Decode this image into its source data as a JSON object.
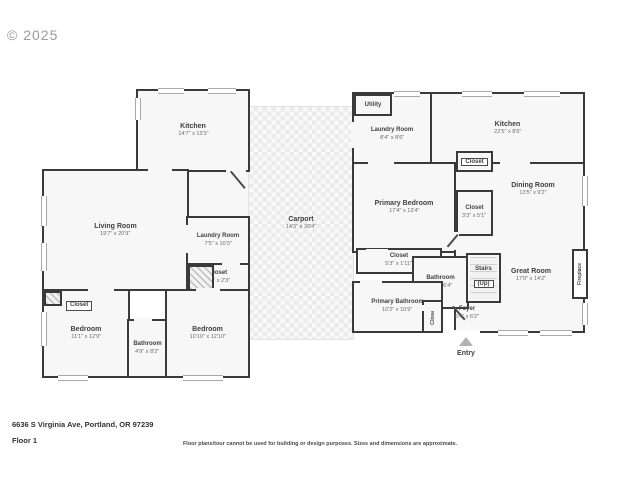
{
  "watermark": "© 2025",
  "colors": {
    "wall": "#3a3a3a",
    "room_fill": "#f7f7f7",
    "carport_check": "#ebebeb"
  },
  "rooms": {
    "kitchen_left": {
      "name": "Kitchen",
      "dims": "14'7\" x 13'3\""
    },
    "living_room": {
      "name": "Living Room",
      "dims": "19'7\" x 20'9\""
    },
    "laundry_left": {
      "name": "Laundry Room",
      "dims": "7'5\" x 10'3\""
    },
    "closet_hall": {
      "name": "Closet",
      "dims": "5'7\" x 2'3\""
    },
    "bedroom_closet": {
      "name": "Closet"
    },
    "bedroom_1": {
      "name": "Bedroom",
      "dims": "11'1\" x 12'9\""
    },
    "bathroom_left": {
      "name": "Bathroom",
      "dims": "4'9\" x 8'2\""
    },
    "bedroom_2": {
      "name": "Bedroom",
      "dims": "10'10\" x 12'10\""
    },
    "carport": {
      "name": "Carport",
      "dims": "14'3\" x 30'4\""
    },
    "utility": {
      "name": "Utility"
    },
    "laundry_right": {
      "name": "Laundry Room",
      "dims": "8'4\" x 8'6\""
    },
    "kitchen_right": {
      "name": "Kitchen",
      "dims": "22'5\" x 8'6\""
    },
    "closet_top": {
      "name": "Closet"
    },
    "primary_bedroom": {
      "name": "Primary Bedroom",
      "dims": "17'4\" x 13'4\""
    },
    "dining_room": {
      "name": "Dining Room",
      "dims": "13'5\" x 9'2\""
    },
    "closet_primary": {
      "name": "Closet",
      "dims": "3'3\" x 5'1\""
    },
    "closet_hall_right": {
      "name": "Closet",
      "dims": "5'3\" x 1'11\""
    },
    "bathroom_right": {
      "name": "Bathroom",
      "dims": "5'9\" x 6'4\""
    },
    "stairs": {
      "name": "Stairs",
      "sub": "(Up)"
    },
    "great_room": {
      "name": "Great Room",
      "dims": "17'0\" x 14'2\""
    },
    "primary_bathroom": {
      "name": "Primary Bathroom",
      "dims": "10'2\" x 10'9\""
    },
    "closet_foyer": {
      "name": "Closet"
    },
    "foyer": {
      "name": "Foyer",
      "dims": "5'4\" x 6'2\""
    },
    "fireplace": {
      "name": "Fireplace"
    },
    "entry": {
      "name": "Entry"
    }
  },
  "footer": {
    "address": "6636 S Virginia Ave, Portland, OR 97239",
    "floor": "Floor 1",
    "disclaimer": "Floor plans/tour cannot be used for building or design purposes. Sizes and dimensions are approximate."
  }
}
